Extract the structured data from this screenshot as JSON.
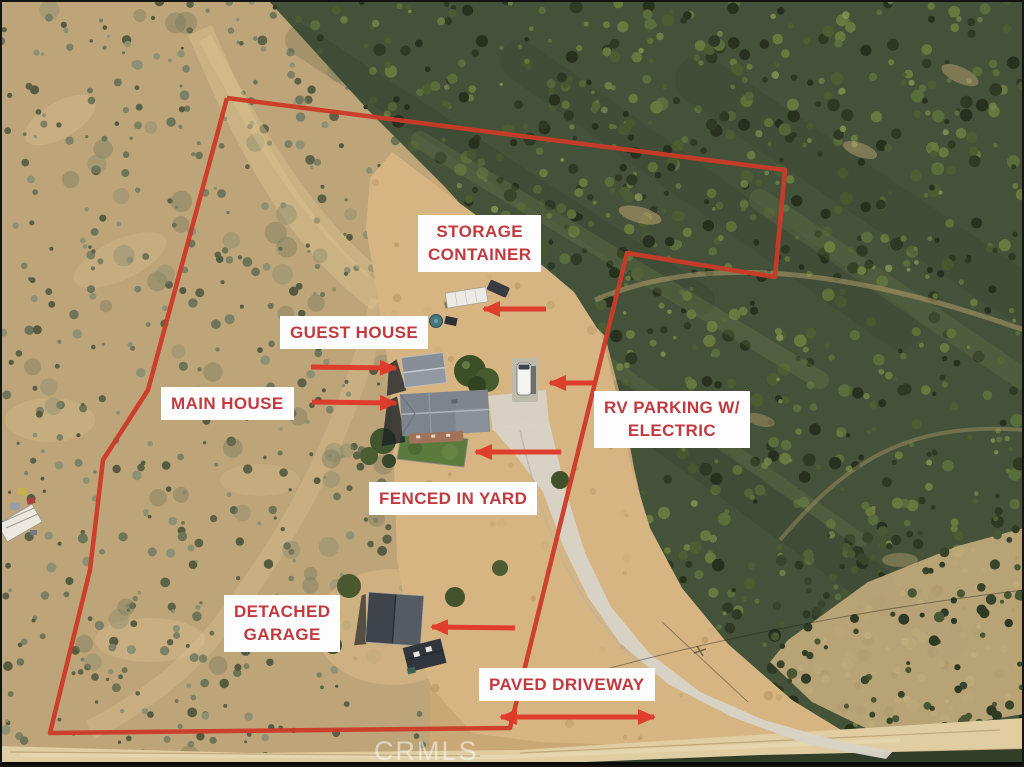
{
  "annotation": {
    "labels": [
      {
        "id": "storage-container",
        "lines": [
          "STORAGE",
          "CONTAINER"
        ]
      },
      {
        "id": "guest-house",
        "lines": [
          "GUEST HOUSE"
        ]
      },
      {
        "id": "main-house",
        "lines": [
          "MAIN HOUSE"
        ]
      },
      {
        "id": "rv-parking",
        "lines": [
          "RV PARKING W/",
          "ELECTRIC"
        ]
      },
      {
        "id": "fenced-yard",
        "lines": [
          "FENCED IN YARD"
        ]
      },
      {
        "id": "detached-garage",
        "lines": [
          "DETACHED",
          "GARAGE"
        ]
      },
      {
        "id": "paved-driveway",
        "lines": [
          "PAVED DRIVEWAY"
        ]
      }
    ],
    "watermark": "CRMLS",
    "colors": {
      "label_text": "#c23a40",
      "label_bg": "#fdfdfd",
      "arrow_red": "#e0392a",
      "boundary_red": "#cb3a28",
      "ground_tan": "#c9a876",
      "chaparral_green": "#45523a",
      "clearing_tan": "#d7b583",
      "watermark_white": "rgba(255,255,255,0.52)"
    }
  }
}
